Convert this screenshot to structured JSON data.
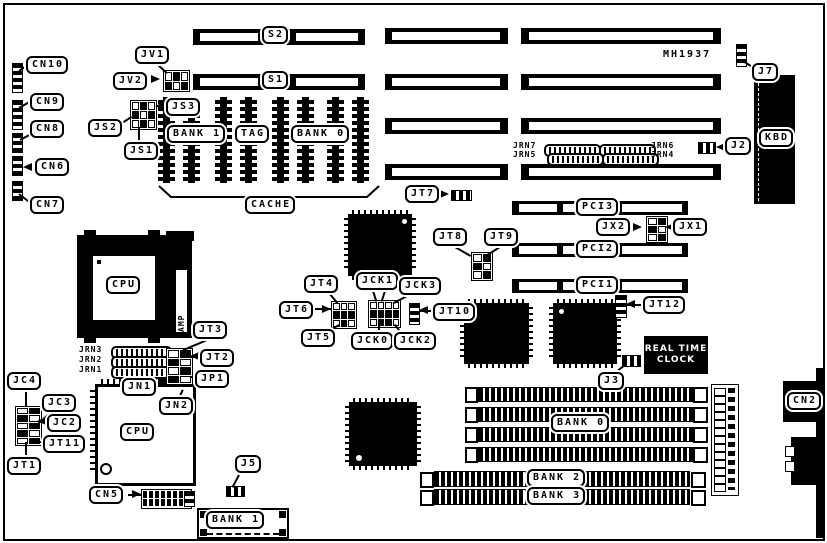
{
  "diagram": {
    "type": "motherboard-jumper-diagram",
    "part_number": "MH1937",
    "colors": {
      "ink": "#000000",
      "background": "#ffffff"
    }
  },
  "labels": {
    "cn10": "CN10",
    "cn9": "CN9",
    "cn8": "CN8",
    "cn7": "CN7",
    "cn6": "CN6",
    "cn5": "CN5",
    "cn2": "CN2",
    "jv1": "JV1",
    "jv2": "JV2",
    "js1": "JS1",
    "js2": "JS2",
    "js3": "JS3",
    "s1": "S1",
    "s2": "S2",
    "bank1_cache": "BANK 1",
    "tag": "TAG",
    "bank0_cache": "BANK 0",
    "cache": "CACHE",
    "mh1937": "MH1937",
    "j2": "J2",
    "j3": "J3",
    "j5": "J5",
    "j7": "J7",
    "kbd": "KBD",
    "jrn7": "JRN7",
    "jrn6": "JRN6",
    "jrn5": "JRN5",
    "jrn4": "JRN4",
    "jrn3": "JRN3",
    "jrn2": "JRN2",
    "jrn1": "JRN1",
    "jt7": "JT7",
    "jt8": "JT8",
    "jt9": "JT9",
    "jt10": "JT10",
    "jt12": "JT12",
    "jx1": "JX1",
    "jx2": "JX2",
    "pci1": "PCI1",
    "pci2": "PCI2",
    "pci3": "PCI3",
    "jt4": "JT4",
    "jt5": "JT5",
    "jt6": "JT6",
    "jck0": "JCK0",
    "jck1": "JCK1",
    "jck2": "JCK2",
    "jck3": "JCK3",
    "jt3": "JT3",
    "jt2": "JT2",
    "jp1": "JP1",
    "jn1": "JN1",
    "jn2": "JN2",
    "jc4": "JC4",
    "jc3": "JC3",
    "jc2": "JC2",
    "jt11": "JT11",
    "jt1": "JT1",
    "cpu_socket": "CPU",
    "cpu_qfp": "CPU",
    "amp": "AMP",
    "rtc_line1": "REAL TIME",
    "rtc_line2": "CLOCK",
    "bank0_simm": "BANK 0",
    "bank1_simm": "BANK 1",
    "bank2_simm": "BANK 2",
    "bank3_simm": "BANK 3"
  }
}
